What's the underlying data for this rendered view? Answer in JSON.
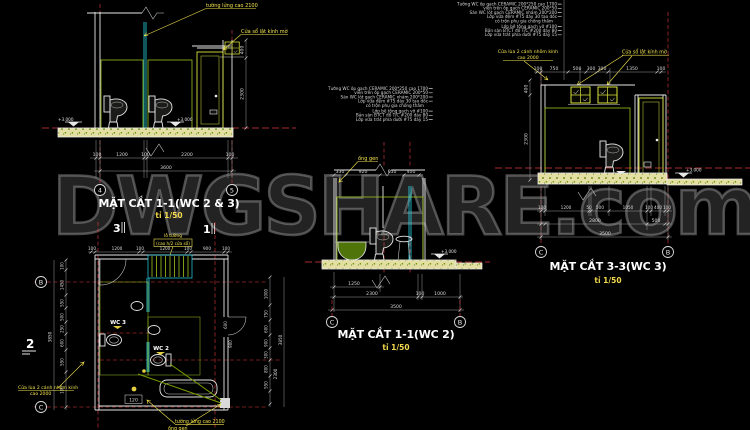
{
  "watermark": "DWGSHARE.com",
  "colors": {
    "background": "#000000",
    "lines_white": "#e6e6e6",
    "tile_green": "#9dc41e",
    "cyan": "#2bd6e8",
    "annotation_yellow": "#f2e34d",
    "axis_red": "#e03a3a",
    "slab_fill": "#e3dfa3"
  },
  "notes": {
    "lines": [
      "Tường WC ốp gạch CERAMIC 200*250 cao 1700",
      "viền trên ốp gạch CERAMIC 200*50",
      "Sàn WC lót gạch CERAMIC nhám 200*200",
      "Lớp vữa đệm #75 dày 30 tạo dốc",
      "có trộn phụ gia chống thấm",
      "Lớp bê tông gạch vỡ #100",
      "Bản sàn BTCT đổ T/C #200 dày 80",
      "Lớp vữa trát phía dưới #75 dày 15"
    ]
  },
  "annotations": {
    "cua_so_lat": "Cửa sổ lật kính mờ",
    "cua_lua": "Cửa lùa 2 cánh nhôm kính",
    "cao_2000": "cao 2000",
    "tuong_lung": "tường lửng cao 2100",
    "ong_gen": "ống gen",
    "lo_tuong": "lỗ tường",
    "lo_tuong_sub": "(cao h/2 cửa sổ)",
    "wall_120": "120",
    "wc2": "WC 2",
    "wc3": "WC 3",
    "level": "+3.000"
  },
  "section1": {
    "title": "MẶT CẮT 1-1(WC 2 & 3)",
    "scale": "tỉ 1/50",
    "bubble_left": "4",
    "bubble_right": "5",
    "dims": [
      "100",
      "1200",
      "100",
      "2200",
      "100"
    ],
    "total": "3600",
    "dim_400": "400",
    "dim_2300": "2300",
    "marker3": "3",
    "marker1": "1"
  },
  "section2": {
    "title": "MẶT CẮT 1-1(WC 2)",
    "scale": "tỉ 1/50",
    "bubble_left": "C",
    "bubble_right": "B",
    "dims_top": [
      "330",
      "920",
      "650",
      "400"
    ],
    "dim_1250": "1250",
    "dims_mid": [
      "2300",
      "100",
      "1000"
    ],
    "total": "3500"
  },
  "section3": {
    "title": "MẶT CẮT 3-3(WC 3)",
    "scale": "tỉ 1/50",
    "bubble_left": "C",
    "bubble_right": "B",
    "dims_top": [
      "100",
      "750",
      "500",
      "300",
      "300",
      "1350",
      "100"
    ],
    "dims_b1": [
      "100",
      "1200",
      "50",
      "500",
      "1050",
      "100",
      "400",
      "100"
    ],
    "dims_b2": [
      "2800",
      "500"
    ],
    "total": "3500",
    "dim_400": "400",
    "dim_2300": "2300"
  },
  "plan": {
    "marker2": "2",
    "marker3": "3",
    "marker1": "1",
    "bubble_top": "B",
    "bubble_bottom": "C",
    "dims_top": [
      "100",
      "1200",
      "100",
      "1200",
      "100",
      "900",
      "100"
    ],
    "dims_left": [
      "100",
      "1450",
      "550",
      "500",
      "250",
      "600",
      "550",
      "100"
    ],
    "left_total": "3850",
    "dims_right": [
      "1000",
      "750",
      "600",
      "900",
      "300",
      "800",
      "550"
    ],
    "right_total": "3850",
    "right_2300": "2300",
    "dims_mid": [
      "600",
      "900"
    ]
  }
}
